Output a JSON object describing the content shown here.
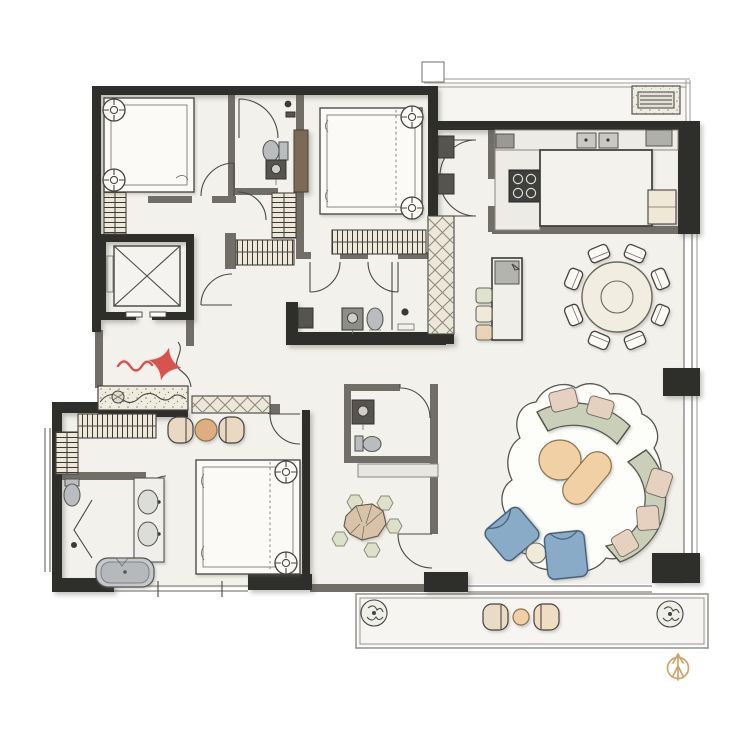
{
  "title": "Apartment floor plan with entry star marker and north compass",
  "compass": {
    "symbol": "north-arrow"
  },
  "entry": {
    "marker": "red-four-point-star",
    "path": "wavy-flourish"
  },
  "counts": {
    "dining_chairs": 8,
    "bar_stools": 3,
    "stepping_stones": 5,
    "balcony_plants": 2,
    "blue_armchairs": 2
  },
  "colors": {
    "floor": "#f2f1ec",
    "floor_balcony": "#f6f5f1",
    "wall_dark": "#2f2d2a",
    "wall_mid": "#716e68",
    "glass": "#9a9792",
    "line": "#4a4843",
    "furniture": "#fbfaf7",
    "counter": "#ecebe5",
    "hatch_fill": "#ece7d8",
    "wood_panel": "#7b6a56",
    "sofa_sage": "#c9cfb9",
    "sofa_stroke": "#5a5b50",
    "cushion": "#e6d0c0",
    "table_tan": "#f0d0a4",
    "table_tan_dark": "#dcae80",
    "chair_blue": "#8aabc7",
    "chair_blue_stroke": "#3f5c77",
    "fixture": "#b9bdc0",
    "fixture_dark": "#55544f",
    "cream": "#efe8d7",
    "stone_green": "#dde1c9",
    "rock": "#d8c3a9",
    "accent_red": "#d9534e",
    "compass_gold": "#cfa26a"
  },
  "rooms": [
    {
      "id": "bedroom-3",
      "name": "Bedroom 3",
      "furniture": [
        "bed",
        "two round side tables",
        "wardrobe rail"
      ]
    },
    {
      "id": "bathroom-2",
      "name": "Bathroom 2",
      "furniture": [
        "shower",
        "toilet",
        "washbasin",
        "wood sliding panel"
      ]
    },
    {
      "id": "bedroom-2",
      "name": "Bedroom 2",
      "furniture": [
        "bed",
        "two round side tables",
        "closet rail"
      ]
    },
    {
      "id": "bathroom-3",
      "name": "Bathroom 3",
      "furniture": [
        "washer",
        "washbasin",
        "toilet",
        "shower"
      ]
    },
    {
      "id": "elevator",
      "name": "Elevator",
      "furniture": [
        "cab with cross"
      ]
    },
    {
      "id": "foyer",
      "name": "Entry Foyer",
      "furniture": [
        "rock planter",
        "shoe bench",
        "entry star marker"
      ]
    },
    {
      "id": "kitchen",
      "name": "Kitchen",
      "furniture": [
        "island",
        "double sink",
        "4-burner cooktop",
        "refrigerator",
        "microwave"
      ]
    },
    {
      "id": "dining",
      "name": "Dining Area",
      "furniture": [
        "round table",
        "8 chairs"
      ]
    },
    {
      "id": "bar-desk",
      "name": "Bar Desk",
      "furniture": [
        "tall desk",
        "3 stools"
      ]
    },
    {
      "id": "living",
      "name": "Living Area",
      "furniture": [
        "two curved sofas",
        "round coffee table",
        "capsule coffee table",
        "2 blue armchairs",
        "side table",
        "organic rug"
      ]
    },
    {
      "id": "powder-room",
      "name": "Powder Room",
      "furniture": [
        "washbasin",
        "toilet",
        "bench shelf"
      ]
    },
    {
      "id": "hall-garden",
      "name": "Hallway Rock Garden",
      "furniture": [
        "5 stepping stones",
        "rock cluster"
      ]
    },
    {
      "id": "master-bedroom",
      "name": "Master Bedroom",
      "furniture": [
        "bed",
        "two round nightstands",
        "two lounge chairs",
        "tea table",
        "wardrobe rails"
      ]
    },
    {
      "id": "master-bathroom",
      "name": "Master Bathroom",
      "furniture": [
        "bathtub",
        "double vanity",
        "toilet",
        "folding shower door"
      ]
    },
    {
      "id": "balcony-top",
      "name": "Service Balcony",
      "furniture": [
        "AC unit"
      ]
    },
    {
      "id": "balcony-bottom",
      "name": "Balcony",
      "furniture": [
        "2 lounge chairs",
        "round tea table",
        "2 potted plants"
      ]
    }
  ]
}
